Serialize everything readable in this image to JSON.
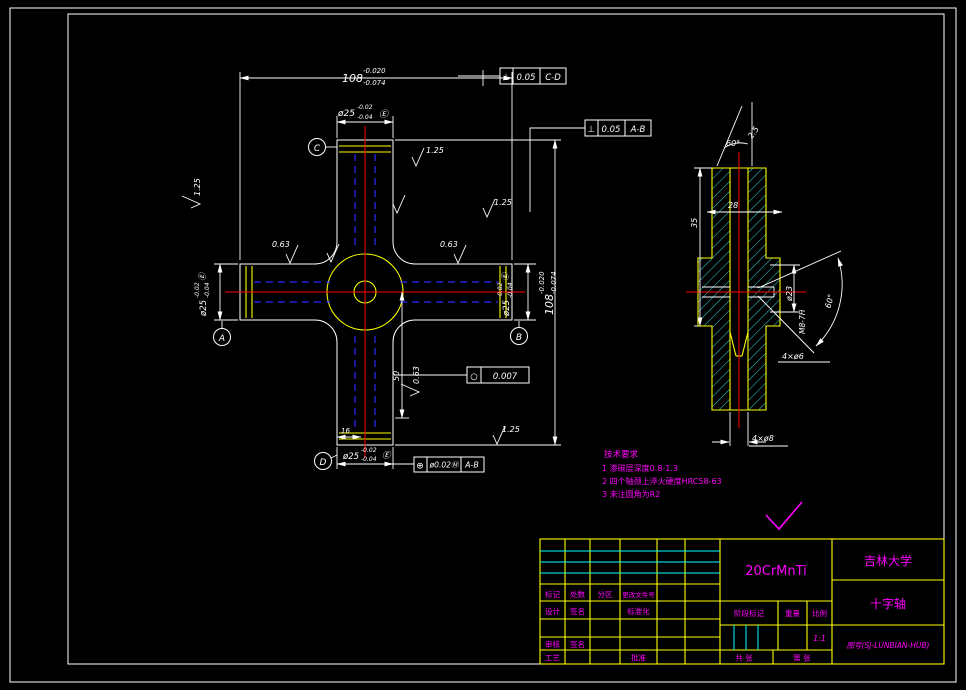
{
  "app": {
    "title": "CAD drawing - cross shaft"
  },
  "colors": {
    "background": "#000000",
    "outline_white": "#ffffff",
    "outline_yellow": "#ffff00",
    "hatch_cyan": "#00ffff",
    "centerline_red": "#ff0000",
    "hidden_blue": "#2a2aff",
    "annotation_magenta": "#ff00ff"
  },
  "front": {
    "dim108": {
      "v": "108",
      "hi": "-0.020",
      "lo": "-0.074"
    },
    "dimJournal": {
      "v": "ø25",
      "hi": "-0.02",
      "lo": "-0.04",
      "env": "Ⓔ"
    },
    "dim50": "50",
    "dim16": "16",
    "datumA": "A",
    "datumB": "B",
    "datumC": "C",
    "datumD": "D",
    "gdt1": {
      "sym": "⊥",
      "tol": "0.05",
      "datum": "C-D"
    },
    "gdt2": {
      "sym": "⊥",
      "tol": "0.05",
      "datum": "A-B"
    },
    "gdt3": {
      "sym": "⊕",
      "tol": "ø0.02Ⓜ",
      "datum": "A-B"
    },
    "gdt4": {
      "sym": "○",
      "tol": "0.007"
    },
    "ra063": "0.63",
    "ra125": "1.25"
  },
  "side": {
    "angleTop": "60°",
    "chamfer": "2.5",
    "d35": "35",
    "d28": "28",
    "d23": "ø23",
    "thread": "M8-7H",
    "angleCone": "60°",
    "holes6": "4×ø6",
    "holes8": "4×ø8"
  },
  "notes": {
    "title": "技术要求",
    "items": [
      "1 渗碳层深度0.8-1.3",
      "2 四个轴颈上淬火硬度HRC58-63",
      "3 未注圆角为R2"
    ]
  },
  "titleblock": {
    "material": "20CrMnTi",
    "organization": "吉林大学",
    "part_name": "十字轴",
    "drawing_no": "图号(SJ-LUNBIAN-HUB)",
    "scale_value": "1:1",
    "labels": {
      "mark": "标记",
      "count": "处数",
      "zone": "分区",
      "change_file": "更改文件号",
      "design": "设计",
      "sign": "签名",
      "standardize": "标准化",
      "review": "审核",
      "sign2": "签名",
      "process": "工艺",
      "approve": "批准",
      "stage_mark": "阶段标记",
      "weight": "重量",
      "scale": "比例",
      "sheets_total": "共  张",
      "sheet_no": "第  张"
    }
  }
}
